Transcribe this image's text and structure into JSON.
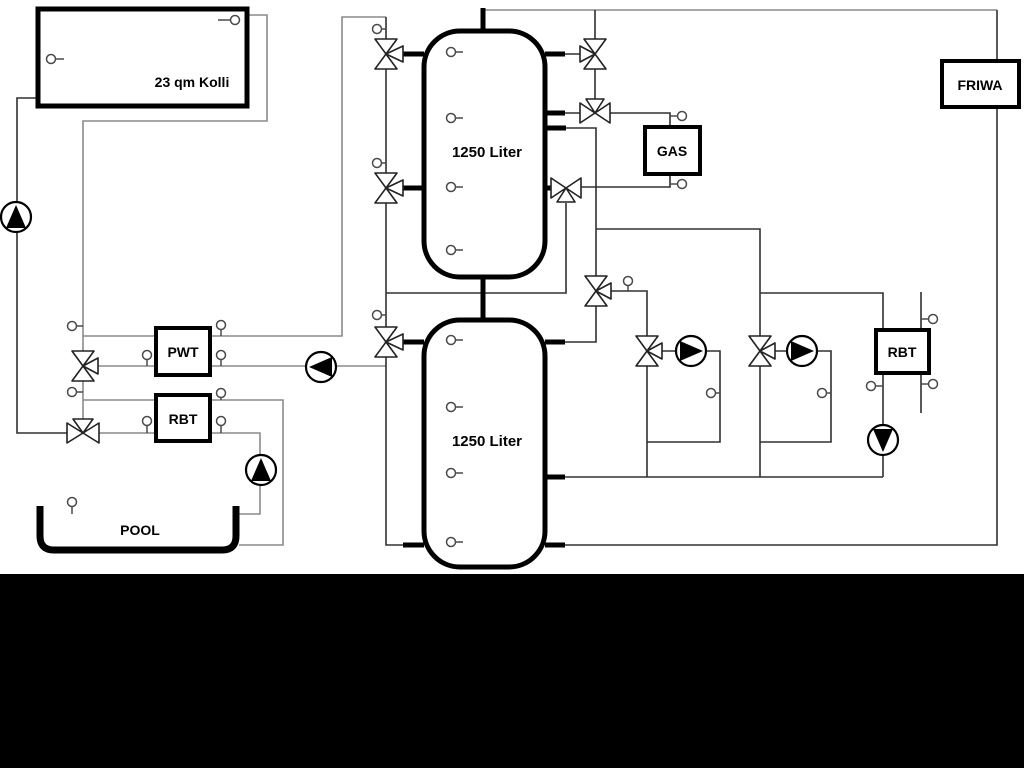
{
  "diagram_title": "solar-pool-heating-hydraulic-schematic",
  "labels": {
    "collector": "23 qm Kolli",
    "tank_top": "1250 Liter",
    "tank_bottom": "1250 Liter",
    "heat_exchanger": "PWT",
    "rbt_left": "RBT",
    "rbt_right": "RBT",
    "gas_boiler": "GAS",
    "fresh_water": "FRIWA",
    "pool": "POOL"
  },
  "colors": {
    "background": "#ffffff",
    "footer_bar": "#000000",
    "pipe_gray": "#8a8a8a",
    "pipe_dark": "#303030",
    "outline_black": "#000000",
    "component_fill": "#ffffff"
  },
  "icons": {
    "pump-icon": "circle with solid triangle showing flow direction",
    "three-way-valve-icon": "bowtie of hollow triangles with third port triangle",
    "temperature-sensor-icon": "small circle on a short stem"
  },
  "counts": {
    "pumps": 6,
    "three_way_valves": 10,
    "temperature_sensors": 30,
    "storage_tanks": 2
  }
}
